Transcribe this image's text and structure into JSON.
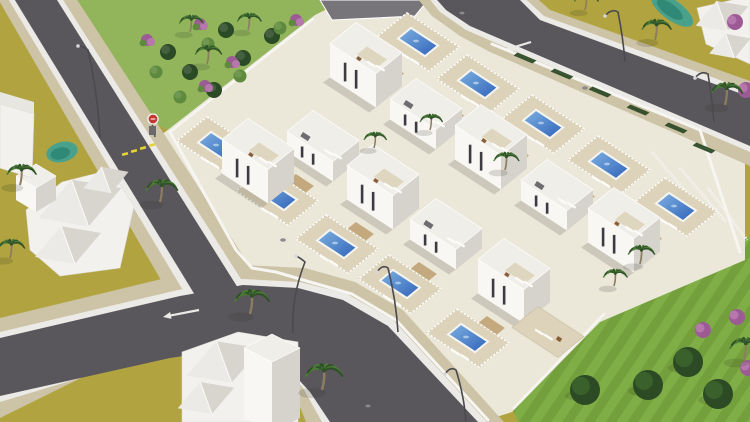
{
  "scene": {
    "canvas": {
      "w": 750,
      "h": 422
    },
    "palette": {
      "ground": "#b1a440",
      "park": "#92b55c",
      "lawn_a": "#7fae47",
      "lawn_b": "#73a03c",
      "road": "#5a575c",
      "curb": "#eceae6",
      "sidewalk": "#cdc3a6",
      "complex_base": "#ebe8da",
      "terrace": "#ddd3ba",
      "terrace_edge": "#c9bda0",
      "villa_front": "#f8f7f4",
      "villa_side": "#d6d3cd",
      "villa_top": "#f0eee8",
      "window": "#3b3b41",
      "pool_light": "#7fb2e2",
      "pool_dark": "#2f62b8",
      "pool_rim": "#f5f5f1",
      "pergola": "#c3a97d",
      "lounger": "#fcfbf8",
      "table_brown": "#8a5f38",
      "pond_outer": "#49a18c",
      "pond_inner": "#2e8674",
      "roof_lit": "#eceae6",
      "roof_shade": "#d8d5cf",
      "house_wall": "#f2f1ee",
      "palm_trunk": "#8d7d60",
      "frond_dark": "#2f5128",
      "frond_light": "#4a7a36",
      "tree": "#2c4a23",
      "tree_hi": "#3f652e",
      "purple": "#9c5b94",
      "purple_hi": "#b677ac",
      "bush_dark": "#2b4a26",
      "bush_light": "#5d8a3c",
      "hedge": "#2e4b27",
      "deck_gray": "#77747a",
      "hatch_gray": "#6e6b71",
      "lamp": "#4a4a4e",
      "lamp_head": "#d8d8da",
      "stop_red": "#c2372f",
      "dash_yellow": "#e8d532",
      "marking_white": "#eaeae6",
      "wall_white": "#f6f5f1",
      "shadow": "rgba(45,45,30,0.16)"
    },
    "roads": [
      {
        "id": "road-a",
        "walk": [
          [
            -6,
            -8
          ],
          [
            72,
            -8
          ],
          [
            264,
            288
          ],
          [
            176,
            306
          ]
        ],
        "curb": [
          [
            4,
            -8
          ],
          [
            58,
            -8
          ],
          [
            248,
            290
          ],
          [
            190,
            302
          ]
        ],
        "dark": [
          [
            10,
            -8
          ],
          [
            52,
            -8
          ],
          [
            238,
            288
          ],
          [
            198,
            300
          ]
        ]
      },
      {
        "id": "road-b",
        "walk": [
          [
            0,
            318
          ],
          [
            174,
            276
          ],
          [
            243,
            265
          ],
          [
            305,
            268
          ],
          [
            355,
            282
          ],
          [
            403,
            310
          ],
          [
            504,
            422
          ],
          [
            306,
            422
          ],
          [
            289,
            380
          ],
          [
            268,
            352
          ],
          [
            246,
            326
          ],
          [
            219,
            330
          ],
          [
            162,
            338
          ],
          [
            0,
            418
          ]
        ],
        "curb": [
          [
            0,
            332
          ],
          [
            178,
            290
          ],
          [
            243,
            279
          ],
          [
            300,
            282
          ],
          [
            347,
            294
          ],
          [
            393,
            320
          ],
          [
            487,
            422
          ],
          [
            322,
            422
          ],
          [
            303,
            388
          ],
          [
            281,
            362
          ],
          [
            254,
            338
          ],
          [
            223,
            344
          ],
          [
            167,
            352
          ],
          [
            0,
            402
          ]
        ],
        "dark": [
          [
            0,
            338
          ],
          [
            180,
            296
          ],
          [
            243,
            285
          ],
          [
            298,
            288
          ],
          [
            343,
            300
          ],
          [
            388,
            326
          ],
          [
            478,
            422
          ],
          [
            330,
            422
          ],
          [
            310,
            392
          ],
          [
            288,
            368
          ],
          [
            258,
            344
          ],
          [
            225,
            350
          ],
          [
            170,
            358
          ],
          [
            0,
            396
          ]
        ]
      },
      {
        "id": "road-c",
        "walk": [
          [
            412,
            -8
          ],
          [
            530,
            -8
          ],
          [
            550,
            10
          ],
          [
            584,
            22
          ],
          [
            750,
            81
          ],
          [
            750,
            166
          ],
          [
            490,
            52
          ],
          [
            460,
            36
          ],
          [
            432,
            16
          ]
        ],
        "curb": [
          [
            424,
            -8
          ],
          [
            518,
            -8
          ],
          [
            544,
            16
          ],
          [
            580,
            29
          ],
          [
            750,
            91
          ],
          [
            750,
            152
          ],
          [
            496,
            43
          ],
          [
            466,
            30
          ],
          [
            440,
            12
          ]
        ],
        "dark": [
          [
            430,
            -8
          ],
          [
            512,
            -8
          ],
          [
            540,
            20
          ],
          [
            578,
            34
          ],
          [
            750,
            97
          ],
          [
            750,
            146
          ],
          [
            498,
            38
          ],
          [
            470,
            26
          ],
          [
            446,
            10
          ]
        ]
      }
    ],
    "markings": {
      "yellow_dashes": [
        [
          125,
          154
        ],
        [
          134,
          151
        ],
        [
          143,
          148
        ],
        [
          152,
          145
        ]
      ],
      "arrows": [
        {
          "tip": [
            163,
            317
          ],
          "tail": [
            199,
            310
          ]
        },
        {
          "tip": [
            505,
            50
          ],
          "tail": [
            531,
            42
          ]
        }
      ],
      "manholes": [
        [
          462,
          13
        ],
        [
          585,
          88
        ],
        [
          368,
          406
        ],
        [
          283,
          240
        ]
      ]
    },
    "park": {
      "poly": [
        [
          64,
          0
        ],
        [
          336,
          0
        ],
        [
          306,
          24
        ],
        [
          170,
          131
        ],
        [
          148,
          120
        ]
      ],
      "bushes_dark": [
        [
          168,
          52
        ],
        [
          190,
          72
        ],
        [
          214,
          90
        ],
        [
          243,
          58
        ],
        [
          272,
          36
        ],
        [
          226,
          30
        ]
      ],
      "bushes_light": [
        [
          180,
          97
        ],
        [
          208,
          44
        ],
        [
          156,
          72
        ],
        [
          240,
          76
        ],
        [
          280,
          28
        ]
      ],
      "bushes_pink": [
        [
          147,
          40
        ],
        [
          200,
          24
        ],
        [
          232,
          62
        ],
        [
          205,
          86
        ],
        [
          296,
          20
        ]
      ]
    },
    "lawn": {
      "poly": [
        [
          604,
          315
        ],
        [
          750,
          236
        ],
        [
          750,
          422
        ],
        [
          518,
          422
        ],
        [
          512,
          408
        ]
      ],
      "trees": [
        [
          585,
          390
        ],
        [
          648,
          385
        ],
        [
          688,
          362
        ],
        [
          718,
          394
        ]
      ],
      "purple": [
        [
          703,
          330
        ],
        [
          737,
          317
        ],
        [
          748,
          368
        ]
      ]
    },
    "shrubs_extra": [
      [
        735,
        22
      ],
      [
        746,
        90
      ]
    ],
    "ponds": [
      {
        "c": [
          62,
          152
        ],
        "rx": 16,
        "ry": 10,
        "rot": -14
      },
      {
        "c": [
          185,
          266
        ],
        "rx": 17,
        "ry": 11,
        "rot": -10
      },
      {
        "c": [
          672,
          10
        ],
        "rx": 25,
        "ry": 10,
        "rot": 36
      }
    ],
    "complex": {
      "base": [
        [
          160,
          136
        ],
        [
          315,
          15
        ],
        [
          345,
          0
        ],
        [
          440,
          0
        ],
        [
          460,
          8
        ],
        [
          745,
          128
        ],
        [
          745,
          260
        ],
        [
          600,
          322
        ],
        [
          512,
          412
        ],
        [
          480,
          422
        ],
        [
          330,
          422
        ],
        [
          300,
          390
        ],
        [
          250,
          300
        ],
        [
          196,
          280
        ]
      ],
      "topdeck": [
        [
          320,
          0
        ],
        [
          428,
          0
        ],
        [
          415,
          16
        ],
        [
          332,
          20
        ]
      ],
      "nw_wall": [
        [
          170,
          132
        ],
        [
          313,
          19
        ]
      ],
      "sw_wall": [
        [
          170,
          132
        ],
        [
          236,
          250
        ],
        [
          252,
          268
        ],
        [
          276,
          272
        ],
        [
          310,
          282
        ],
        [
          352,
          294
        ],
        [
          396,
          320
        ],
        [
          488,
          420
        ]
      ],
      "ne_wall": [
        [
          492,
          44
        ],
        [
          700,
          130
        ],
        [
          740,
          252
        ]
      ],
      "se_wall": [
        [
          604,
          314
        ],
        [
          514,
          408
        ]
      ],
      "hedges": [
        [
          525,
          58
        ],
        [
          562,
          74
        ],
        [
          600,
          92
        ],
        [
          638,
          110
        ],
        [
          676,
          128
        ],
        [
          704,
          148
        ]
      ],
      "east_slats": [
        [
          [
            652,
            152
          ],
          [
            698,
            206
          ]
        ],
        [
          [
            680,
            168
          ],
          [
            726,
            222
          ]
        ],
        [
          [
            708,
            188
          ],
          [
            747,
            240
          ]
        ]
      ],
      "extra_terrace": {
        "c": [
          548,
          332
        ]
      }
    },
    "villas": [
      {
        "pool": [
          418,
          42
        ],
        "house": [
          366,
          82
        ],
        "ts": true,
        "hatch": false
      },
      {
        "pool": [
          478,
          84
        ],
        "house": [
          426,
          124
        ],
        "ts": false,
        "hatch": true
      },
      {
        "pool": [
          277,
          196
        ],
        "house": [
          323,
          156
        ],
        "ts": false,
        "hatch": true
      },
      {
        "pool": [
          543,
          124
        ],
        "house": [
          491,
          164
        ],
        "ts": true,
        "hatch": false
      },
      {
        "pool": [
          218,
          146
        ],
        "house": [
          258,
          178
        ],
        "ts": true,
        "hatch": false
      },
      {
        "pool": [
          337,
          244
        ],
        "house": [
          383,
          204
        ],
        "ts": true,
        "hatch": false
      },
      {
        "pool": [
          609,
          165
        ],
        "house": [
          557,
          205
        ],
        "ts": false,
        "hatch": true
      },
      {
        "pool": [
          400,
          284
        ],
        "house": [
          446,
          244
        ],
        "ts": false,
        "hatch": true
      },
      {
        "pool": [
          676,
          207
        ],
        "house": [
          624,
          247
        ],
        "ts": true,
        "hatch": false
      },
      {
        "pool": [
          468,
          338
        ],
        "house": [
          514,
          298
        ],
        "ts": true,
        "hatch": false
      }
    ],
    "houses": [
      {
        "id": "house-left",
        "base": [
          [
            26,
            210
          ],
          [
            62,
            182
          ],
          [
            110,
            170
          ],
          [
            134,
            206
          ],
          [
            120,
            268
          ],
          [
            60,
            276
          ],
          [
            30,
            250
          ]
        ],
        "roofs": [
          {
            "c": [
              80,
              203
            ],
            "rx": 44,
            "ry": 25
          },
          {
            "c": [
              68,
              245
            ],
            "rx": 35,
            "ry": 20
          },
          {
            "c": [
              106,
              180
            ],
            "rx": 24,
            "ry": 14
          }
        ],
        "tower": {
          "top": [
            [
              36,
              164
            ],
            [
              56,
              176
            ],
            [
              36,
              188
            ],
            [
              16,
              176
            ]
          ],
          "h": 24
        }
      },
      {
        "id": "house-bottom",
        "base": [
          [
            182,
            352
          ],
          [
            238,
            332
          ],
          [
            298,
            342
          ],
          [
            298,
            422
          ],
          [
            182,
            422
          ]
        ],
        "roofs": [
          {
            "c": [
              224,
              362
            ],
            "rx": 40,
            "ry": 22
          },
          {
            "c": [
              206,
              398
            ],
            "rx": 30,
            "ry": 17
          }
        ],
        "tower": {
          "top": [
            [
              272,
              334
            ],
            [
              300,
              348
            ],
            [
              272,
              362
            ],
            [
              244,
              348
            ]
          ],
          "h": 70
        }
      },
      {
        "id": "house-topright",
        "base": [
          [
            697,
            8
          ],
          [
            750,
            -4
          ],
          [
            750,
            64
          ],
          [
            706,
            44
          ]
        ],
        "roofs": [
          {
            "c": [
              722,
              16
            ],
            "rx": 28,
            "ry": 16
          },
          {
            "c": [
              730,
              46
            ],
            "rx": 22,
            "ry": 13
          }
        ]
      },
      {
        "id": "house-leftedge",
        "base": [
          [
            0,
            104
          ],
          [
            34,
            114
          ],
          [
            32,
            178
          ],
          [
            0,
            168
          ]
        ],
        "roofs": [],
        "flat_top": [
          [
            0,
            92
          ],
          [
            34,
            102
          ],
          [
            34,
            114
          ],
          [
            0,
            104
          ]
        ]
      }
    ],
    "palms": [
      [
        190,
        32,
        0.9
      ],
      [
        207,
        64,
        1.0
      ],
      [
        248,
        30,
        0.9
      ],
      [
        20,
        185,
        1.1
      ],
      [
        10,
        258,
        1.0
      ],
      [
        160,
        202,
        1.2
      ],
      [
        250,
        314,
        1.3
      ],
      [
        322,
        390,
        1.4
      ],
      [
        374,
        148,
        0.85
      ],
      [
        430,
        130,
        0.85
      ],
      [
        505,
        170,
        0.95
      ],
      [
        640,
        264,
        1.0
      ],
      [
        614,
        286,
        0.9
      ],
      [
        655,
        40,
        1.1
      ],
      [
        725,
        105,
        1.2
      ],
      [
        585,
        10,
        0.9
      ],
      [
        744,
        360,
        1.2
      ]
    ],
    "lamps": [
      {
        "base": [
          100,
          138
        ],
        "top": [
          88,
          50
        ],
        "head": [
          78,
          46
        ]
      },
      {
        "base": [
          293,
          333
        ],
        "top": [
          305,
          262
        ],
        "head": [
          296,
          256
        ]
      },
      {
        "base": [
          398,
          332
        ],
        "top": [
          388,
          268
        ],
        "head": [
          377,
          272
        ]
      },
      {
        "base": [
          466,
          421
        ],
        "top": [
          456,
          370
        ],
        "head": [
          445,
          374
        ]
      },
      {
        "base": [
          625,
          62
        ],
        "top": [
          618,
          12
        ],
        "head": [
          605,
          16
        ]
      },
      {
        "base": [
          714,
          122
        ],
        "top": [
          708,
          74
        ],
        "head": [
          695,
          78
        ]
      }
    ],
    "stop_sign": {
      "pos": [
        152,
        118
      ]
    }
  }
}
